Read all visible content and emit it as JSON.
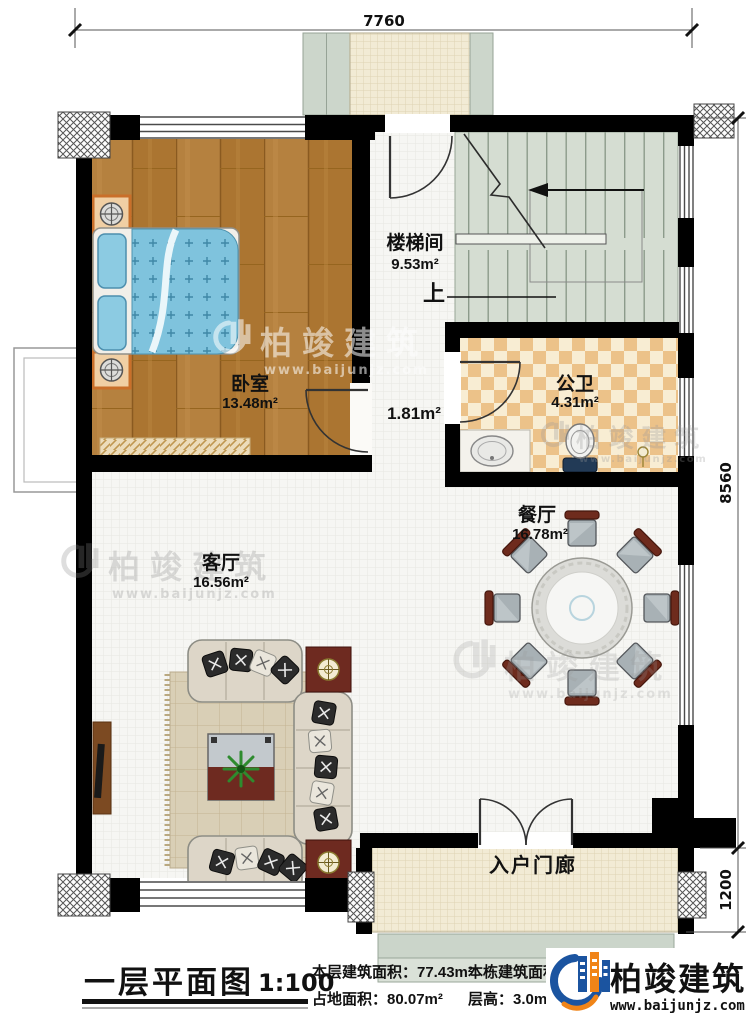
{
  "plan": {
    "title": "一层平面图",
    "scale": "1:100",
    "stats": {
      "floor_area": "本层建筑面积：77.43m²",
      "land_area": "占地面积：80.07m²",
      "total_area": "本栋建筑面积：232.22m²",
      "story_height": "层高：3.0m"
    }
  },
  "brand": {
    "name": "柏竣建筑",
    "website": "www.baijunjz.com"
  },
  "dimensions": {
    "top_width": "7760",
    "right_main": "8560",
    "right_porch": "1200"
  },
  "rooms": {
    "stairwell": {
      "name": "楼梯间",
      "area": "9.53m²"
    },
    "bedroom": {
      "name": "卧室",
      "area": "13.48m²"
    },
    "bathroom": {
      "name": "公卫",
      "area": "4.31m²"
    },
    "dining": {
      "name": "餐厅",
      "area": "16.78m²"
    },
    "living": {
      "name": "客厅",
      "area": "16.56m²"
    },
    "porch": {
      "name": "入户门廊"
    },
    "hallway": {
      "area": "1.81m²"
    }
  },
  "annotations": {
    "stairs_up": "上"
  },
  "colors": {
    "wall": "#000000",
    "wood_floor": "#b5813f",
    "bed_blue": "#7fc3dd",
    "stair_floor": "#d5ddd2",
    "bath_tile": "#ecc289",
    "porch_floor": "#f2ebd5",
    "table_wood": "#6e2a20",
    "brand_blue": "#1b54a0",
    "brand_orange": "#f08418"
  }
}
